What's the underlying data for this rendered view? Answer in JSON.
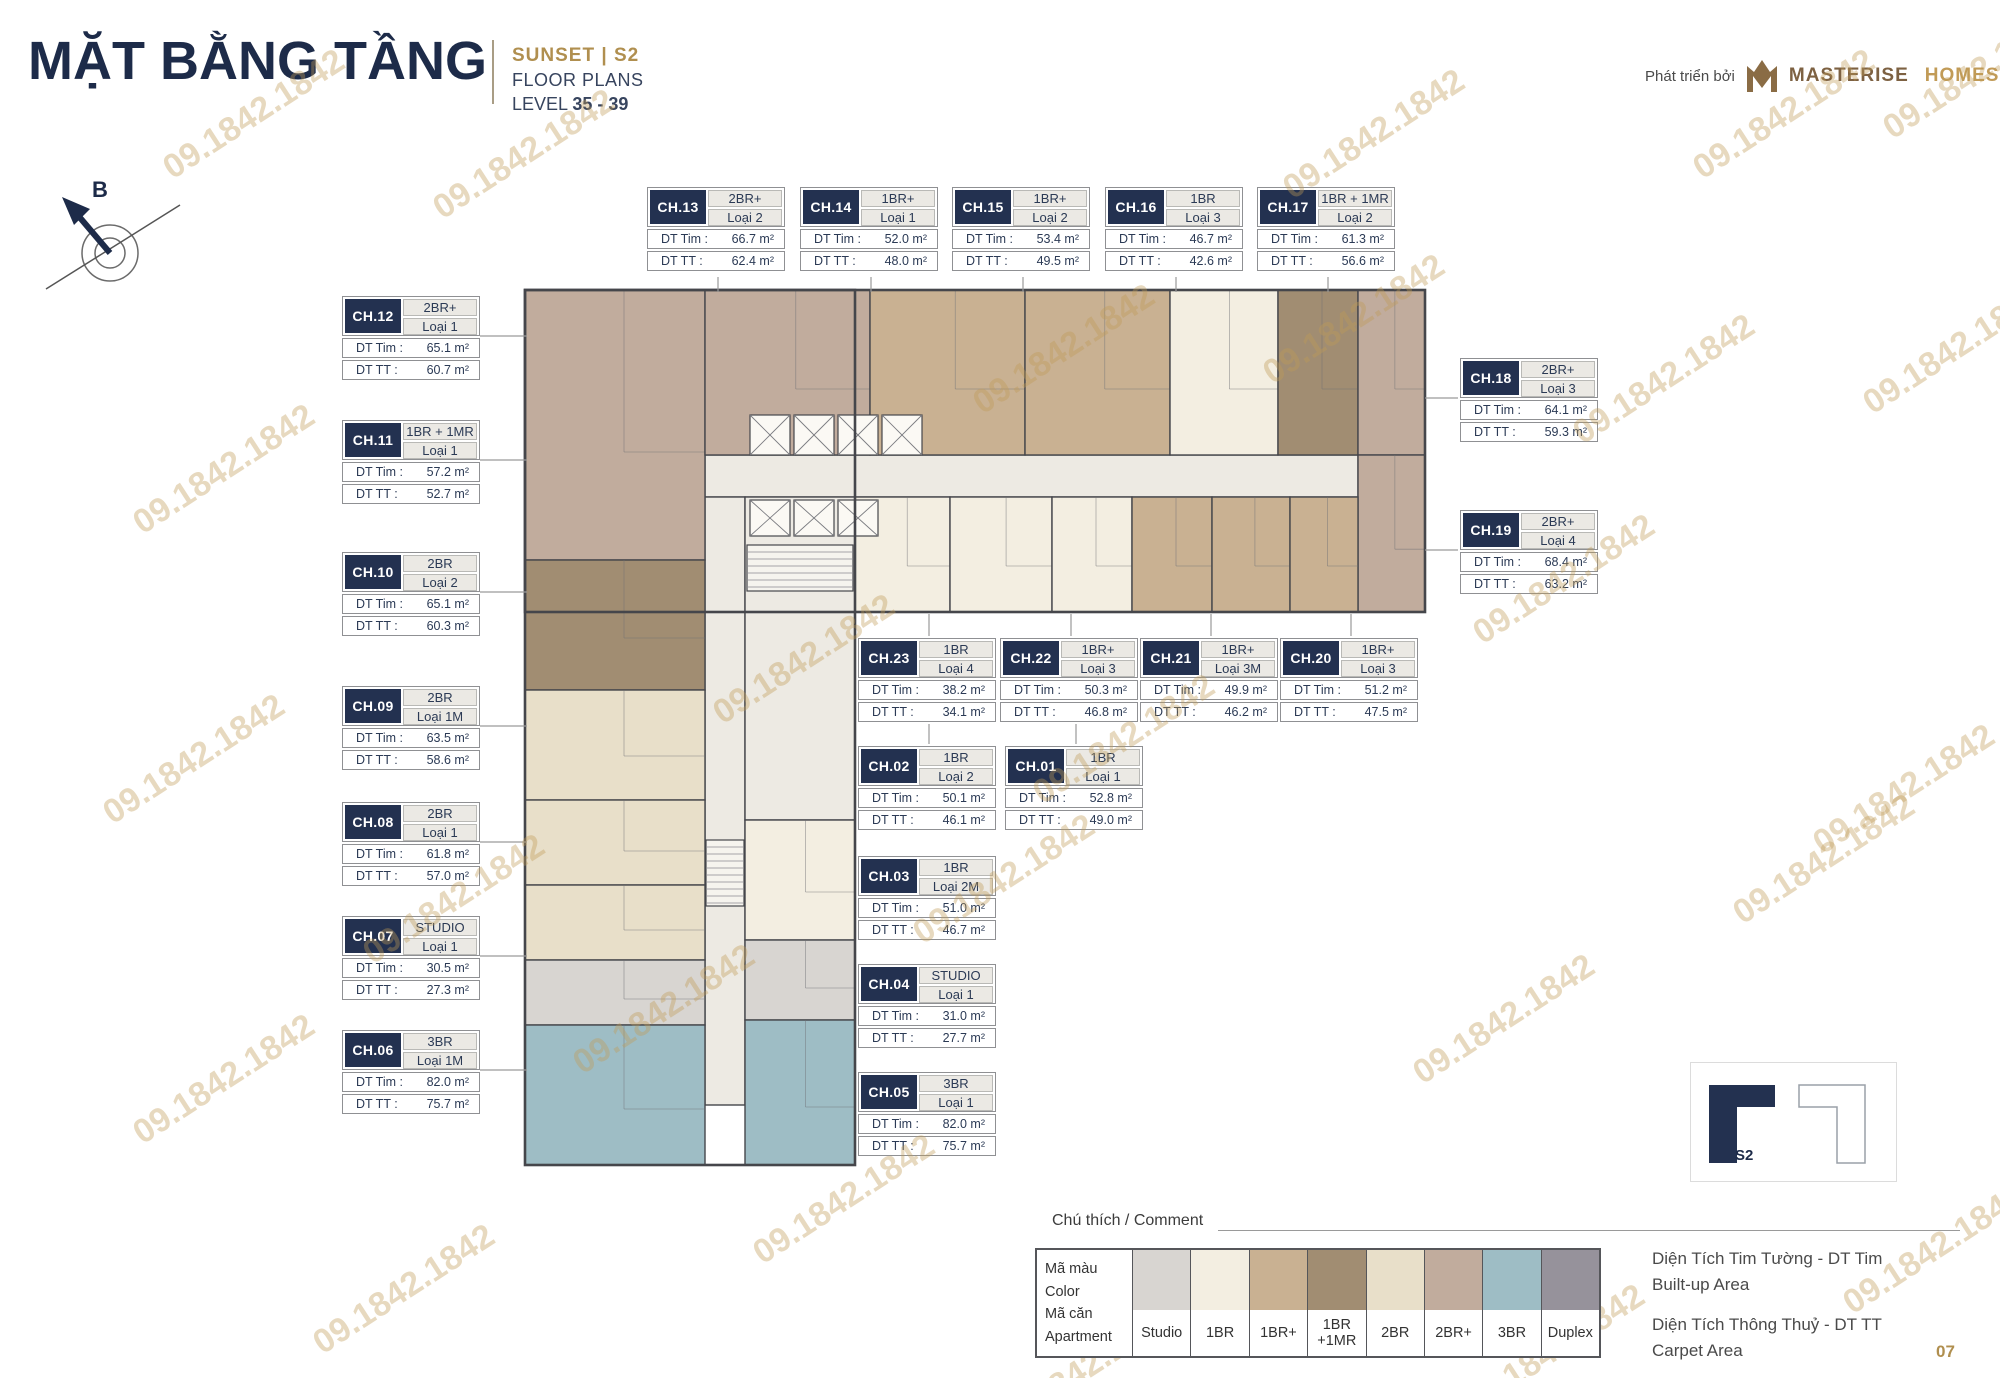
{
  "header": {
    "title": "MẶT BẰNG TẦNG",
    "project": "SUNSET  |  S2",
    "subtitle": "FLOOR PLANS",
    "level_label": "LEVEL ",
    "level_value": "35 - 39",
    "developer_label": "Phát triển bởi",
    "developer_name_1": "MASTERISE",
    "developer_name_2": "HOMES"
  },
  "compass": {
    "north_label": "B"
  },
  "labels": {
    "dt_tim": "DT Tim :",
    "dt_tt": "DT TT :"
  },
  "units": [
    {
      "code": "CH.01",
      "type": "1BR",
      "variant": "Loại 1",
      "dt_tim": "52.8 m²",
      "dt_tt": "49.0 m²"
    },
    {
      "code": "CH.02",
      "type": "1BR",
      "variant": "Loại 2",
      "dt_tim": "50.1 m²",
      "dt_tt": "46.1 m²"
    },
    {
      "code": "CH.03",
      "type": "1BR",
      "variant": "Loại 2M",
      "dt_tim": "51.0 m²",
      "dt_tt": "46.7 m²"
    },
    {
      "code": "CH.04",
      "type": "STUDIO",
      "variant": "Loại 1",
      "dt_tim": "31.0 m²",
      "dt_tt": "27.7 m²"
    },
    {
      "code": "CH.05",
      "type": "3BR",
      "variant": "Loại 1",
      "dt_tim": "82.0 m²",
      "dt_tt": "75.7 m²"
    },
    {
      "code": "CH.06",
      "type": "3BR",
      "variant": "Loại 1M",
      "dt_tim": "82.0 m²",
      "dt_tt": "75.7 m²"
    },
    {
      "code": "CH.07",
      "type": "STUDIO",
      "variant": "Loại 1",
      "dt_tim": "30.5 m²",
      "dt_tt": "27.3 m²"
    },
    {
      "code": "CH.08",
      "type": "2BR",
      "variant": "Loại 1",
      "dt_tim": "61.8 m²",
      "dt_tt": "57.0 m²"
    },
    {
      "code": "CH.09",
      "type": "2BR",
      "variant": "Loại 1M",
      "dt_tim": "63.5 m²",
      "dt_tt": "58.6 m²"
    },
    {
      "code": "CH.10",
      "type": "2BR",
      "variant": "Loại 2",
      "dt_tim": "65.1 m²",
      "dt_tt": "60.3 m²"
    },
    {
      "code": "CH.11",
      "type": "1BR + 1MR",
      "variant": "Loại 1",
      "dt_tim": "57.2 m²",
      "dt_tt": "52.7 m²"
    },
    {
      "code": "CH.12",
      "type": "2BR+",
      "variant": "Loại 1",
      "dt_tim": "65.1 m²",
      "dt_tt": "60.7 m²"
    },
    {
      "code": "CH.13",
      "type": "2BR+",
      "variant": "Loại 2",
      "dt_tim": "66.7 m²",
      "dt_tt": "62.4 m²"
    },
    {
      "code": "CH.14",
      "type": "1BR+",
      "variant": "Loại 1",
      "dt_tim": "52.0 m²",
      "dt_tt": "48.0 m²"
    },
    {
      "code": "CH.15",
      "type": "1BR+",
      "variant": "Loại 2",
      "dt_tim": "53.4 m²",
      "dt_tt": "49.5 m²"
    },
    {
      "code": "CH.16",
      "type": "1BR",
      "variant": "Loại 3",
      "dt_tim": "46.7 m²",
      "dt_tt": "42.6 m²"
    },
    {
      "code": "CH.17",
      "type": "1BR + 1MR",
      "variant": "Loại 2",
      "dt_tim": "61.3 m²",
      "dt_tt": "56.6 m²"
    },
    {
      "code": "CH.18",
      "type": "2BR+",
      "variant": "Loại 3",
      "dt_tim": "64.1 m²",
      "dt_tt": "59.3 m²"
    },
    {
      "code": "CH.19",
      "type": "2BR+",
      "variant": "Loại 4",
      "dt_tim": "68.4 m²",
      "dt_tt": "63.2 m²"
    },
    {
      "code": "CH.20",
      "type": "1BR+",
      "variant": "Loại 3",
      "dt_tim": "51.2 m²",
      "dt_tt": "47.5 m²"
    },
    {
      "code": "CH.21",
      "type": "1BR+",
      "variant": "Loại 3M",
      "dt_tim": "49.9 m²",
      "dt_tt": "46.2 m²"
    },
    {
      "code": "CH.22",
      "type": "1BR+",
      "variant": "Loại 3",
      "dt_tim": "50.3 m²",
      "dt_tt": "46.8 m²"
    },
    {
      "code": "CH.23",
      "type": "1BR",
      "variant": "Loại 4",
      "dt_tim": "38.2 m²",
      "dt_tt": "34.1 m²"
    }
  ],
  "legend": {
    "title": "Chú thích / Comment",
    "row_color_vi": "Mã màu",
    "row_color_en": "Color",
    "row_apt_vi": "Mã căn",
    "row_apt_en": "Apartment",
    "items": [
      {
        "label": "Studio",
        "color": "#d8d5d1"
      },
      {
        "label": "1BR",
        "color": "#f3eee1"
      },
      {
        "label": "1BR+",
        "color": "#c9b192"
      },
      {
        "label": "1BR\n+1MR",
        "color": "#a18d72"
      },
      {
        "label": "2BR",
        "color": "#e8dfc9"
      },
      {
        "label": "2BR+",
        "color": "#c1ac9d"
      },
      {
        "label": "3BR",
        "color": "#9ebdc5"
      },
      {
        "label": "Duplex",
        "color": "#96929b"
      }
    ]
  },
  "notes": [
    {
      "vi": "Diện Tích Tim Tường - DT Tim",
      "en": "Built-up Area"
    },
    {
      "vi": "Diện Tích Thông Thuỷ - DT TT",
      "en": "Carpet Area"
    }
  ],
  "key_plan": {
    "label": "S2"
  },
  "watermark": "09.1842.1842",
  "page_number": "07",
  "theme": {
    "navy": "#233150",
    "gold": "#b08f4f",
    "corridor": "#edeae3"
  }
}
